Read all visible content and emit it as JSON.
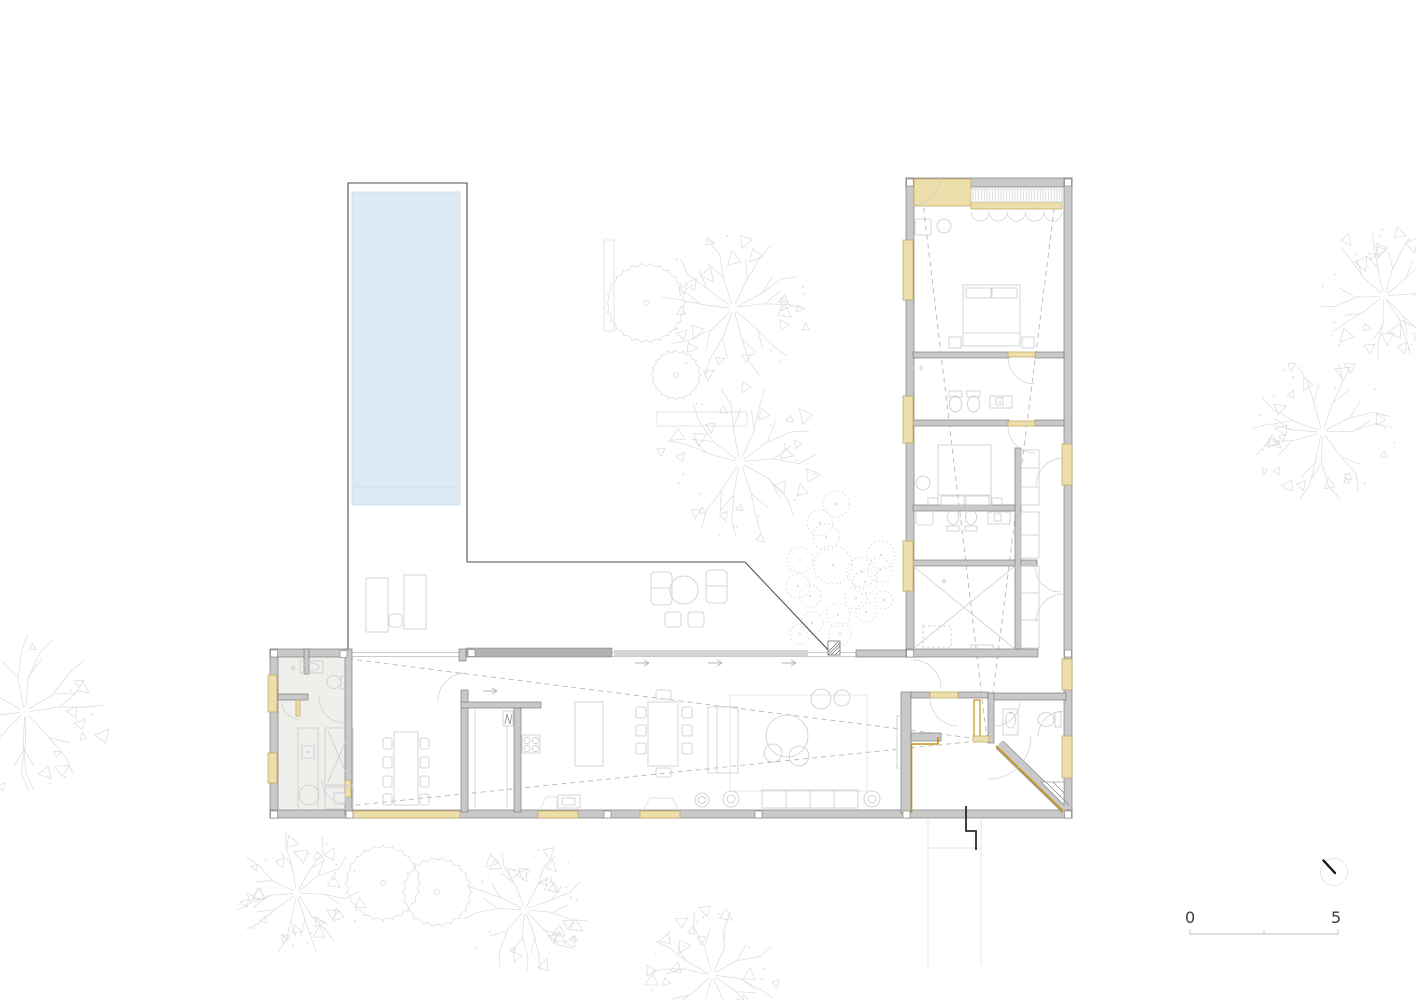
{
  "drawing": {
    "kind": "residential floor plan",
    "scale_bar": {
      "zero_label": "0",
      "five_label": "5"
    },
    "icons": {
      "north_arrow": "north-arrow-icon"
    }
  },
  "colors": {
    "wall_fill": "#c9c9c9",
    "wall_edge": "#7e7e7e",
    "panel_dark": "#b2b2b2",
    "panel_light": "#d4d4d4",
    "tan_fill": "#ecdfab",
    "tan_edge": "#bfa35c",
    "gold": "#c2920f",
    "pool_fill": "#dde9f3",
    "pool_edge": "#c9dcec",
    "floor_tint": "#f0efec",
    "furniture": "#c7cacd",
    "swing": "#ccced1",
    "dashed": "#b5b8ba",
    "deck_line": "#4e4e4e",
    "track": "#b9b9b9",
    "faint": "#e3e3e3",
    "arrowc": "#b2b5b8",
    "tree": "#d9dbdd",
    "shrub": "#d2d4d6",
    "hatch_dark": "#6f6f6f",
    "curtain": "#d4d6d8",
    "text": "#3c3c3c",
    "scale_line": "#d6d6d6",
    "section_mark": "#2b2b2b",
    "north_ring": "#e6e6e6",
    "needle": "#161616"
  }
}
